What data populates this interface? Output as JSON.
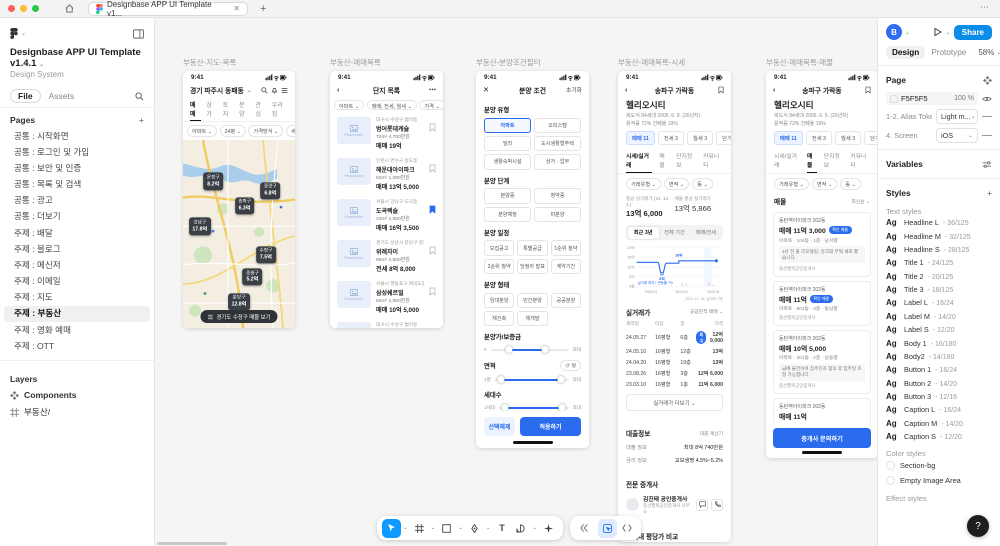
{
  "common": {
    "time": "9:41"
  },
  "chrome": {
    "tab_title": "Designbase APP UI Template v1..."
  },
  "sidebar": {
    "title": "Designbase APP UI Template v1.4.1",
    "subtitle": "Design System",
    "tab_file": "File",
    "tab_assets": "Assets",
    "pages_label": "Pages",
    "pages": [
      {
        "label": "공통 : 시작화면"
      },
      {
        "label": "공통 : 로그인 및 가입"
      },
      {
        "label": "공통 : 보안 및 인증"
      },
      {
        "label": "공통 : 목록 및 검색"
      },
      {
        "label": "공통 : 광고"
      },
      {
        "label": "공통 : 더보기"
      },
      {
        "label": "주제 : 배달"
      },
      {
        "label": "주제 : 블로그"
      },
      {
        "label": "주제 : 메신저"
      },
      {
        "label": "주제 : 이메일"
      },
      {
        "label": "주제 : 지도"
      },
      {
        "label": "주제 : 부동산",
        "cls": "active"
      },
      {
        "label": "주제 : 영화 예매"
      },
      {
        "label": "주제 : OTT"
      }
    ],
    "layers_label": "Layers",
    "components_label": "Components",
    "frame_label": "부동산/"
  },
  "frame1": {
    "title": "부동산-지도-목록",
    "location": "경기 파주시 동패동",
    "tabs": [
      {
        "label": "매매",
        "cls": "on"
      },
      {
        "label": "상가"
      },
      {
        "label": "토지"
      },
      {
        "label": "분양"
      },
      {
        "label": "관심"
      },
      {
        "label": "우리집"
      }
    ],
    "chips": [
      "아파트",
      "24평",
      "가격방식",
      "세대수"
    ],
    "pills": [
      {
        "name": "운정구",
        "price": "8.2억",
        "x": 27,
        "y": 22
      },
      {
        "name": "중랑구",
        "price": "6.8억",
        "x": 78,
        "y": 27
      },
      {
        "name": "송파구",
        "price": "6.3억",
        "x": 55,
        "y": 35
      },
      {
        "name": "강남구",
        "price": "17.8억",
        "x": 15,
        "y": 46
      },
      {
        "name": "수정구",
        "price": "7.5억",
        "x": 74,
        "y": 61
      },
      {
        "name": "중원구",
        "price": "5.2억",
        "x": 62,
        "y": 73
      },
      {
        "name": "분당구",
        "price": "12.8억",
        "x": 50,
        "y": 86
      }
    ],
    "bottom_pill": "경기도 수정구 매물 보기"
  },
  "frame2": {
    "title": "부동산-매매목록",
    "nav_title": "단지 목록",
    "chips": [
      "아파트",
      "매매, 전세, 월세",
      "가격",
      "평형"
    ],
    "placeholder": "Placeholder",
    "items": [
      {
        "addr": "대구시 수성구 범어동",
        "name": "범어롯데캐슬",
        "size": "72m² 4,700만원",
        "price": "매매 19억"
      },
      {
        "addr": "인천시 연수구 송도동",
        "name": "해운대아이파크",
        "size": "92m² 1,090만원",
        "price": "매매 13억 5,000"
      },
      {
        "addr": "서울시 강남구 도곡동",
        "name": "도곡렉슬",
        "size": "33m² 2,550만원",
        "price": "매매 16억 3,500",
        "cls": "saved"
      },
      {
        "addr": "경기도 성남시 분당구 정자동",
        "name": "위례자이",
        "size": "95m² 3,500만원",
        "price": "전세 8억 8,000"
      },
      {
        "addr": "서울시 영등포구 여의도동",
        "name": "삼성쉐르빌",
        "size": "66m² 2,950만원",
        "price": "매매 10억 5,000"
      },
      {
        "addr": "대구시 수성구 범어동",
        "name": "범어롯데캐슬",
        "size": "72m² 4,700만원",
        "price": "매매 19억"
      }
    ]
  },
  "frame3": {
    "title": "부동산-분양조건필터",
    "nav_title": "분양 조건",
    "reset": "초기화",
    "type_title": "분양 유형",
    "type_chips": [
      {
        "label": "아파트",
        "cls": "sel"
      },
      {
        "label": "오피스텔"
      },
      {
        "label": "빌라"
      },
      {
        "label": "도시생활형주택"
      },
      {
        "label": "생활숙박시설"
      },
      {
        "label": "상가 · 업무"
      }
    ],
    "stage_title": "분양 단계",
    "stage_chips": [
      {
        "label": "분양중"
      },
      {
        "label": "청약중"
      },
      {
        "label": "분양예정"
      },
      {
        "label": "미분양"
      }
    ],
    "schedule_title": "분양 일정",
    "schedule_chips": [
      {
        "label": "모집공고"
      },
      {
        "label": "특별공급"
      },
      {
        "label": "1순위 청약"
      },
      {
        "label": "2순위 청약"
      },
      {
        "label": "당첨자 발표"
      },
      {
        "label": "계약기간"
      }
    ],
    "form_title": "분양 형태",
    "form_chips": [
      {
        "label": "임대분양"
      },
      {
        "label": "민간분양"
      },
      {
        "label": "공공분양"
      },
      {
        "label": "재건축"
      },
      {
        "label": "재개발"
      }
    ],
    "price_title": "분양가/보증금",
    "price_min": "0",
    "price_max": "최대",
    "area_title": "면적",
    "area_unit": "평",
    "area_min": "1평",
    "area_max": "최대",
    "hh_title": "세대수",
    "hh_min": "1세대",
    "hh_max": "최대",
    "clear": "선택해제",
    "apply": "적용하기"
  },
  "frame4": {
    "title": "부동산-매매목록-시세",
    "nav_title": "송파구 가락동",
    "complex": "헬리오시티",
    "info1": "복도식 84세대 2005. 6. 9. (20년차)",
    "info2": "용적률 72% 건폐율 19%",
    "deal_chips": [
      {
        "label": "매매 11",
        "cls": "sel"
      },
      {
        "label": "전세 3"
      },
      {
        "label": "월세 3"
      },
      {
        "label": "단기"
      }
    ],
    "tabs": [
      {
        "label": "시세/실거래",
        "cls": "on"
      },
      {
        "label": "매물"
      },
      {
        "label": "단지정보"
      },
      {
        "label": "커뮤니티"
      }
    ],
    "filters": [
      "거래유형",
      "면적",
      "동"
    ],
    "stat1_label": "평균 실거래가 (24. 12. 4.)",
    "stat1_value": "13억 6,000",
    "stat2_label": "매물 평균 실거래가",
    "stat2_value": "13억 5,866",
    "segments": [
      {
        "label": "최근 3년",
        "cls": "on"
      },
      {
        "label": "전체 기간"
      },
      {
        "label": "매매/전세"
      }
    ],
    "chart": {
      "type": "line",
      "y_ticks": [
        "24억",
        "18억",
        "12억",
        "6억",
        "0원"
      ],
      "x_ticks": [
        "2023.01",
        "2024.01",
        "2025.01"
      ],
      "dip_label": "8억",
      "peak_label": "16억",
      "note": "실거래 최저ㅣ변동률 7%",
      "caption": "2024. 12. 26. 실거래 기준",
      "series": [
        15.5,
        15.5,
        8,
        15,
        15,
        16,
        15.8
      ]
    },
    "trades_title": "실거래가",
    "trades_filter": "공급면적 매매",
    "th": [
      "계약일",
      "타입",
      "층",
      "가격"
    ],
    "trades": [
      {
        "d": "24.05.27",
        "t": "16평형",
        "f": "6층",
        "badge": "최고",
        "p": "12억 9,000"
      },
      {
        "d": "24.05.10",
        "t": "16평형",
        "f": "12층",
        "p": "13억"
      },
      {
        "d": "24.04.20",
        "t": "16평형",
        "f": "19층",
        "p": "13억"
      },
      {
        "d": "23.08.26",
        "t": "16평형",
        "f": "3층",
        "p": "12억 6,000"
      },
      {
        "d": "23.03.10",
        "t": "16평형",
        "f": "1층",
        "p": "11억 6,000"
      }
    ],
    "more": "실거래가 더보기",
    "loan_title": "대출정보",
    "loan_link": "대출 계산기",
    "loan_rows": [
      {
        "k": "대출 정보",
        "v": "최대 8억 740만원"
      },
      {
        "k": "금리 정보",
        "v": "교보생명 4.5%~5.2%"
      }
    ],
    "agent_title": "전문 중개사",
    "agent_name": "김진태 공인중개사",
    "agent_firm": "중산행복공인중개사 사무소",
    "compare_title": "지역내 평당가 비교"
  },
  "frame5": {
    "title": "부동산-매매목록-매물",
    "nav_title": "송파구 가락동",
    "complex": "헬리오시티",
    "info1": "복도식 84세대 2005. 6. 9. (20년차)",
    "info2": "용적률 72% 건폐율 19%",
    "deal_chips": [
      {
        "label": "매매 11",
        "cls": "sel"
      },
      {
        "label": "전세 3"
      },
      {
        "label": "월세 3"
      },
      {
        "label": "단기"
      }
    ],
    "tabs": [
      {
        "label": "시세/실거래"
      },
      {
        "label": "매물",
        "cls": "on"
      },
      {
        "label": "단지정보"
      },
      {
        "label": "커뮤니티"
      }
    ],
    "filters": [
      "거래유형",
      "면적",
      "동"
    ],
    "section_title": "매물",
    "sort": "최신순",
    "cards": [
      {
        "name": "동탄역아이파크 202동",
        "price": "매매 11억 3,000",
        "badge": "확인 매물",
        "detail": "아파트 · 104동 · 1층 · 남서향",
        "quote": "1년 전 올 리모델링, 싱크대 부엌 새로 했습니다.",
        "agent": "중산행복공인중개사"
      },
      {
        "name": "동탄역아이파크 202동",
        "price": "매매 11억",
        "badge": "확인 매물",
        "detail": "아파트 · 601동 · 3층 · 동남향",
        "agent": "중산행복공인중개사"
      },
      {
        "name": "동탄역아이파크 202동",
        "price": "매매 10억 5,000",
        "detail": "아파트 · 201동 · 2층 · 남동향",
        "quote": "급매 물건이며 집주인과 협의 후 입주일 조정 가능합니다.",
        "agent": "중산행복공인중개사"
      },
      {
        "name": "동탄역아이파크 202동",
        "price": "매매 11억",
        "detail": "아파트 · 104동 · 저층 · 남서향",
        "agent": "중산행복공인중개사"
      }
    ],
    "cta": "중개사 문의하기"
  },
  "right_panel": {
    "avatar": "B",
    "share": "Share",
    "design": "Design",
    "prototype": "Prototype",
    "zoom": "58%",
    "page_label": "Page",
    "page_color": "F5F5F5",
    "page_opacity": "100",
    "pct": "%",
    "rows": [
      {
        "label": "1-2. Alias Token",
        "value": "Light m..."
      },
      {
        "label": "4. Screen",
        "value": "iOS"
      }
    ],
    "variables_label": "Variables",
    "styles_label": "Styles",
    "text_styles_label": "Text styles",
    "ag": "Ag",
    "text_styles": [
      {
        "name": "Headline L",
        "meta": "36/125"
      },
      {
        "name": "Headline M",
        "meta": "32/125"
      },
      {
        "name": "Headline S",
        "meta": "28/125"
      },
      {
        "name": "Title 1",
        "meta": "24/125"
      },
      {
        "name": "Title 2",
        "meta": "20/125"
      },
      {
        "name": "Title 3",
        "meta": "18/125"
      },
      {
        "name": "Label L",
        "meta": "16/24"
      },
      {
        "name": "Label M",
        "meta": "14/20"
      },
      {
        "name": "Label S",
        "meta": "12/20"
      },
      {
        "name": "Body 1",
        "meta": "16/180"
      },
      {
        "name": "Body2",
        "meta": "14/180"
      },
      {
        "name": "Button 1",
        "meta": "16/24"
      },
      {
        "name": "Button 2",
        "meta": "14/20"
      },
      {
        "name": "Button 3",
        "meta": "12/16"
      },
      {
        "name": "Caption L",
        "meta": "16/24"
      },
      {
        "name": "Caption M",
        "meta": "14/20"
      },
      {
        "name": "Caption S",
        "meta": "12/20"
      }
    ],
    "color_styles_label": "Color styles",
    "color_styles": [
      {
        "name": "Section-bg"
      },
      {
        "name": "Empty Image Area"
      }
    ],
    "effect_styles_label": "Effect styles"
  },
  "help": "?"
}
